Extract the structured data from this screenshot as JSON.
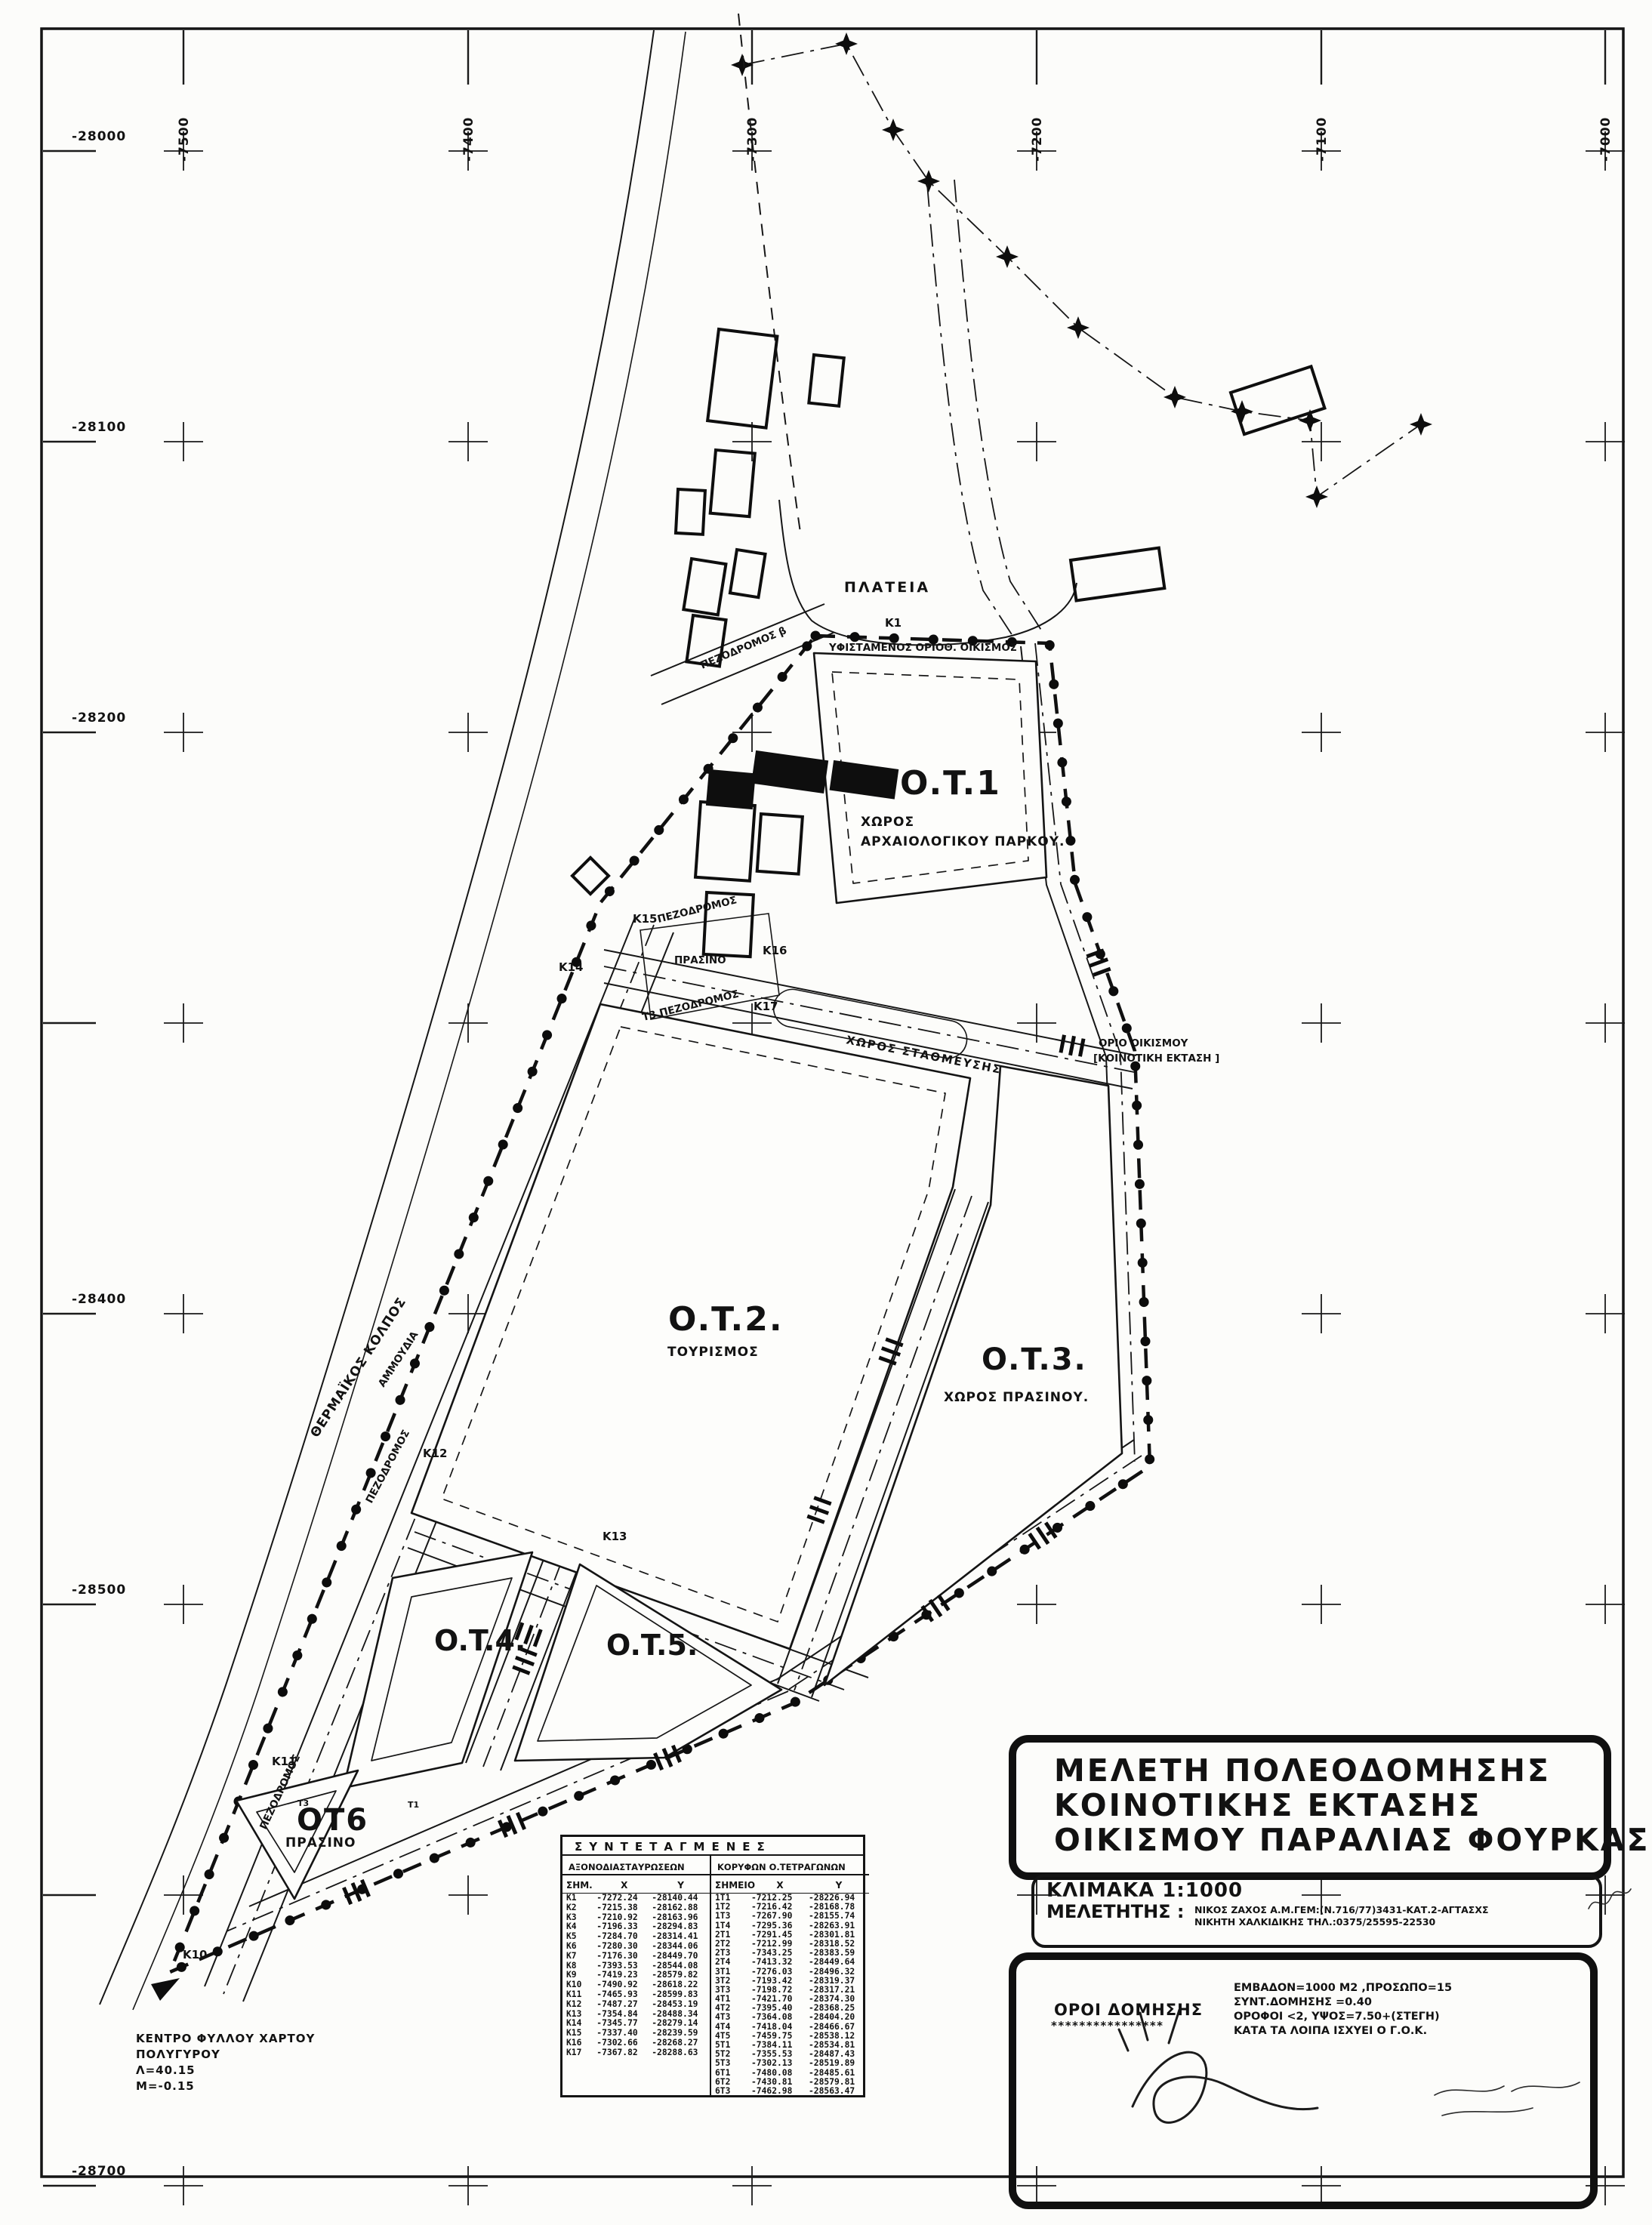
{
  "grid": {
    "top_labels": [
      {
        "label": "-7500",
        "col": 0
      },
      {
        "label": "-7400",
        "col": 1
      },
      {
        "label": "-7300",
        "col": 2
      },
      {
        "label": "-7200",
        "col": 3
      },
      {
        "label": "-7100",
        "col": 4
      },
      {
        "label": "-7000",
        "col": 5
      }
    ],
    "left_labels": [
      {
        "label": "-28000",
        "row": 0
      },
      {
        "label": "-28100",
        "row": 1
      },
      {
        "label": "-28200",
        "row": 2
      },
      {
        "label": "-28400",
        "row": 4
      },
      {
        "label": "-28500",
        "row": 5
      },
      {
        "label": "-28700",
        "row": 7
      }
    ]
  },
  "map": {
    "labels": {
      "sea": "ΘΕΡΜΑΪΚΟΣ ΚΟΛΠΟΣ",
      "beach": "ΑΜΜΟΥΔΙΑ",
      "plateia": "ΠΛΑΤΕΙΑ",
      "existing": "ΥΦΙΣΤΑΜΕΝΟΣ ΟΡΙΟΘ. ΟΙΚΙΣΜΟΣ",
      "pez_beta": "ΠΕΖΟΔΡΟΜΟΣ β",
      "pez_1": "ΠΕΖΟΔΡΟΜΟΣ",
      "pez_2": "ΠΕΖΟΔΡΟΜΟΣ",
      "pez_3": "ΠΕΖΟΔΡΟΜΟΣ",
      "t3_pez": "Τ3 ΠΕΖΟΔΡΟΜΟΣ",
      "parking": "ΧΩΡΟΣ ΣΤΑΘΜΕΥΣΗΣ",
      "prasino_mid": "ΠΡΑΣΙΝΟ",
      "orio_1": "ΟΡΙΟ ΟΙΚΙΣΜΟΥ",
      "orio_2": "[ΚΟΙΝΟΤΙΚΗ ΕΚΤΑΣΗ ]",
      "ot1": "O.T.1",
      "ot1_sub1": "ΧΩΡΟΣ",
      "ot1_sub2": "ΑΡΧΑΙΟΛΟΓΙΚΟΥ ΠΑΡΚΟΥ.",
      "ot2": "O.T.2.",
      "ot2_sub": "ΤΟΥΡΙΣΜΟΣ",
      "ot3": "O.T.3.",
      "ot3_sub": "ΧΩΡΟΣ ΠΡΑΣΙΝΟΥ.",
      "ot4": "O.T.4.",
      "ot5": "O.T.5.",
      "ot6": "ΟΤ6",
      "ot6_sub": "ΠΡΑΣΙΝΟ"
    },
    "points": {
      "k1": "Κ1",
      "k10": "Κ10",
      "k11": "Κ11",
      "k12": "Κ12",
      "k13": "Κ13",
      "k14": "Κ14",
      "k15": "Κ15",
      "k16": "Κ16",
      "k17": "Κ17",
      "t1": "Τ1",
      "t3": "Τ3"
    }
  },
  "title_block": {
    "line1": "ΜΕΛΕΤΗ ΠΟΛΕΟΔΟΜΗΣΗΣ",
    "line2": "ΚΟΙΝΟΤΙΚΗΣ ΕΚΤΑΣΗΣ",
    "line3": "ΟΙΚΙΣΜΟΥ ΠΑΡΑΛΙΑΣ ΦΟΥΡΚΑΣ"
  },
  "scale_block": {
    "scale_label": "ΚΛΙΜΑΚΑ 1:1000",
    "consultant_label": "ΜΕΛΕΤΗΤΗΣ :",
    "consultant_line1": "ΝΙΚΟΣ ΖΑΧΟΣ Α.Μ.ΓΕΜ:(Ν.716/77)3431-ΚΑΤ.2-ΑΓΤΑΣΧΣ",
    "consultant_line2": "ΝΙΚΗΤΗ ΧΑΛΚΙΔΙΚΗΣ ΤΗΛ.:0375/25595-22530"
  },
  "terms_block": {
    "label": "ΟΡΟΙ ΔΟΜΗΣΗΣ",
    "underline": "****************",
    "lines": [
      "ΕΜΒΑΔΟΝ=1000 Μ2 ,ΠΡΟΣΩΠΟ=15",
      "ΣΥΝΤ.ΔΟΜΗΣΗΣ =0.40",
      "ΟΡΟΦΟΙ <2, ΥΨΟΣ=7.50+(ΣΤΕΓΗ)",
      "ΚΑΤΑ ΤΑ ΛΟΙΠΑ ΙΣΧΥΕΙ Ο Γ.Ο.Κ."
    ]
  },
  "coords_table": {
    "title": "ΣΥΝΤΕΤΑΓΜΕΝΕΣ",
    "left_header": "ΑΞΟΝΟΔΙΑΣΤΑΥΡΩΣΕΩΝ",
    "right_header": "ΚΟΡΥΦΩΝ  Ο.ΤΕΤΡΑΓΩΝΩΝ",
    "left_cols": {
      "id": "ΣΗΜ.",
      "x": "Χ",
      "y": "Υ"
    },
    "right_cols": {
      "id": "ΣΗΜΕΙΟ",
      "x": "Χ",
      "y": "Υ"
    },
    "left_rows": [
      [
        "Κ1",
        "-7272.24",
        "-28140.44"
      ],
      [
        "Κ2",
        "-7215.38",
        "-28162.88"
      ],
      [
        "Κ3",
        "-7210.92",
        "-28163.96"
      ],
      [
        "Κ4",
        "-7196.33",
        "-28294.83"
      ],
      [
        "Κ5",
        "-7284.70",
        "-28314.41"
      ],
      [
        "Κ6",
        "-7280.30",
        "-28344.06"
      ],
      [
        "Κ7",
        "-7176.30",
        "-28449.70"
      ],
      [
        "Κ8",
        "-7393.53",
        "-28544.08"
      ],
      [
        "Κ9",
        "-7419.23",
        "-28579.82"
      ],
      [
        "Κ10",
        "-7490.92",
        "-28618.22"
      ],
      [
        "Κ11",
        "-7465.93",
        "-28599.83"
      ],
      [
        "Κ12",
        "-7487.27",
        "-28453.19"
      ],
      [
        "Κ13",
        "-7354.84",
        "-28488.34"
      ],
      [
        "Κ14",
        "-7345.77",
        "-28279.14"
      ],
      [
        "Κ15",
        "-7337.40",
        "-28239.59"
      ],
      [
        "Κ16",
        "-7302.66",
        "-28268.27"
      ],
      [
        "Κ17",
        "-7367.82",
        "-28288.63"
      ]
    ],
    "right_rows": [
      [
        "1Τ1",
        "-7212.25",
        "-28226.94"
      ],
      [
        "1Τ2",
        "-7216.42",
        "-28168.78"
      ],
      [
        "1Τ3",
        "-7267.90",
        "-28155.74"
      ],
      [
        "1Τ4",
        "-7295.36",
        "-28263.91"
      ],
      [
        "2Τ1",
        "-7291.45",
        "-28301.81"
      ],
      [
        "2Τ2",
        "-7212.99",
        "-28318.52"
      ],
      [
        "2Τ3",
        "-7343.25",
        "-28383.59"
      ],
      [
        "2Τ4",
        "-7413.32",
        "-28449.64"
      ],
      [
        "3Τ1",
        "-7276.03",
        "-28496.32"
      ],
      [
        "3Τ2",
        "-7193.42",
        "-28319.37"
      ],
      [
        "3Τ3",
        "-7198.72",
        "-28317.21"
      ],
      [
        "4Τ1",
        "-7421.70",
        "-28374.30"
      ],
      [
        "4Τ2",
        "-7395.40",
        "-28368.25"
      ],
      [
        "4Τ3",
        "-7364.08",
        "-28404.20"
      ],
      [
        "4Τ4",
        "-7418.04",
        "-28466.67"
      ],
      [
        "4Τ5",
        "-7459.75",
        "-28538.12"
      ],
      [
        "5Τ1",
        "-7384.11",
        "-28534.81"
      ],
      [
        "5Τ2",
        "-7355.53",
        "-28487.43"
      ],
      [
        "5Τ3",
        "-7302.13",
        "-28519.89"
      ],
      [
        "6Τ1",
        "-7480.08",
        "-28485.61"
      ],
      [
        "6Τ2",
        "-7430.81",
        "-28579.81"
      ],
      [
        "6Τ3",
        "-7462.98",
        "-28563.47"
      ]
    ]
  },
  "note": {
    "lines": [
      "ΚΕΝΤΡΟ  ΦΥΛΛΟΥ  ΧΑΡΤΟΥ",
      "ΠΟΛΥΓΥΡΟΥ",
      "Λ=40.15",
      "Μ=-0.15"
    ]
  }
}
